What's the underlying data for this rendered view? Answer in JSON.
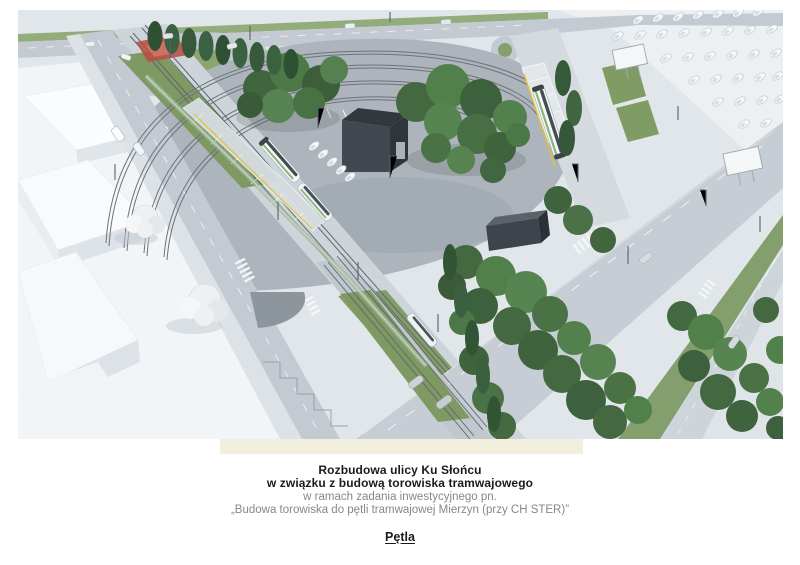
{
  "theme": {
    "page-bg": "#ffffff",
    "strip-bg": "#f3efde",
    "caption-color": "#1b1b1d",
    "caption-muted": "#85878a"
  },
  "render": {
    "colors": {
      "ground": "#e1e6eb",
      "white_terrain": "#f2f5f7",
      "road": "#c3cad1",
      "loop_pavement": "#adb4bb",
      "grass": "#7e9a62",
      "trees_dark": "#3f633d",
      "trees_light": "#578552",
      "dark_building": "#42484f",
      "red_zone": "#b84f44",
      "tram_body": "#f5f8f9",
      "platform_yellow": "#e2c235",
      "rail": "#5f676f"
    }
  },
  "caption": {
    "title_line1": "Rozbudowa ulicy Ku Słońcu",
    "title_line2": "w związku z budową torowiska tramwajowego",
    "subtitle_line1": "w ramach zadania inwestycyjnego pn.",
    "subtitle_line2": "„Budowa torowiska do pętli tramwajowej Mierzyn (przy CH STER)”",
    "label": "Pętla"
  }
}
